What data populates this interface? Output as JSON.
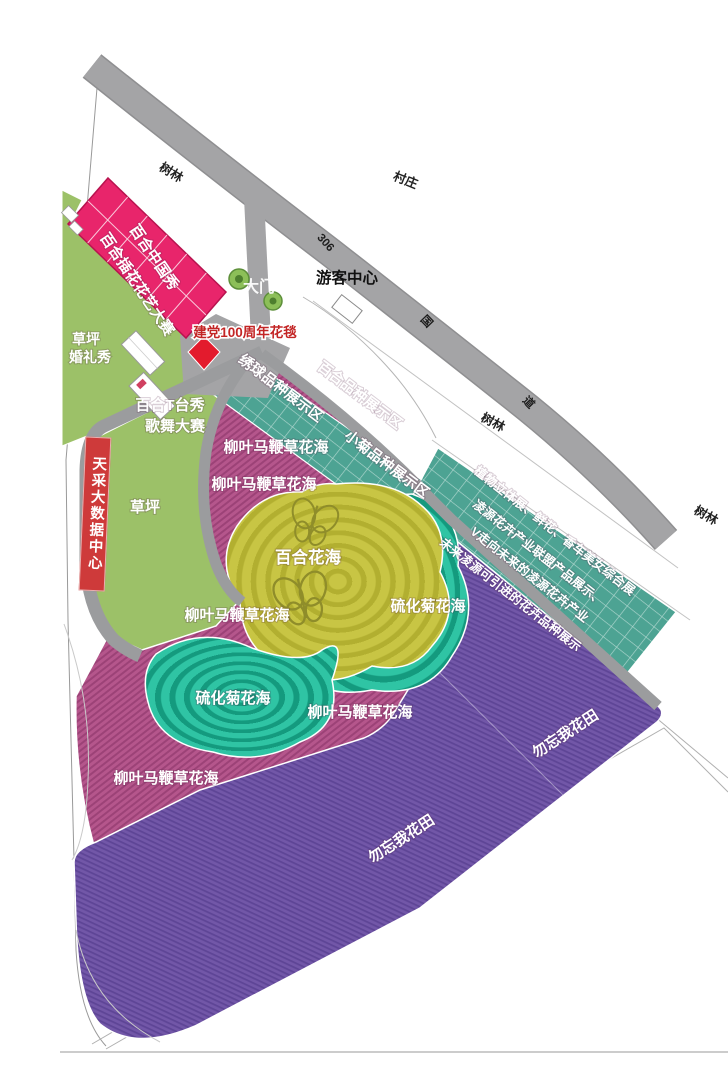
{
  "title": "活动分布总平面图",
  "colors": {
    "title_pink": "#d95872",
    "road_gray": "#a4a4a6",
    "lawn_green": "#9cc168",
    "building_pink": "#e8256b",
    "display_grid_teal": "#4da393",
    "verbena_magenta": "#b5568c",
    "lily_yellow": "#c8c544",
    "sulfur_teal": "#2fc4a4",
    "forget_me_not_purple": "#7257a8",
    "carpet_red": "#e31b2d",
    "banner_red": "#ce3a3a"
  },
  "roads": {
    "route_number": "306",
    "guo": "国",
    "dao": "道"
  },
  "surroundings": {
    "forest": "树林",
    "village": "村庄"
  },
  "entrance": {
    "gate": "大门",
    "visitor_center": "游客中心",
    "flower_carpet": "建党100周年花毯"
  },
  "venues": {
    "lily_china_show": "百合中国秀",
    "lily_flower_art_contest": "百合插花花艺大赛",
    "lawn_wedding_line1": "草坪",
    "lawn_wedding_line2": "婚礼秀",
    "lily_stage_show_line1": "百合T台秀",
    "lily_stage_show_line2": "歌舞大赛",
    "data_center": "天采大数据中心",
    "lawn": "草坪"
  },
  "display_zones": {
    "hydrangea": "绣球品种展示区",
    "lily": "百合品种展示区",
    "small_chrysanthemum": "小菊品种展示区",
    "lines": [
      "植物立体展、鲜花、香车美女综合展",
      "凌源花卉产业联盟产品展示、",
      "V走向未来的凌源花卉产业",
      "未来凌源可引进的花卉品种展示"
    ]
  },
  "flower_fields": {
    "verbena": "柳叶马鞭草花海",
    "lily": "百合花海",
    "sulfur_chrysanthemum": "硫化菊花海",
    "forget_me_not": "勿忘我花田"
  }
}
